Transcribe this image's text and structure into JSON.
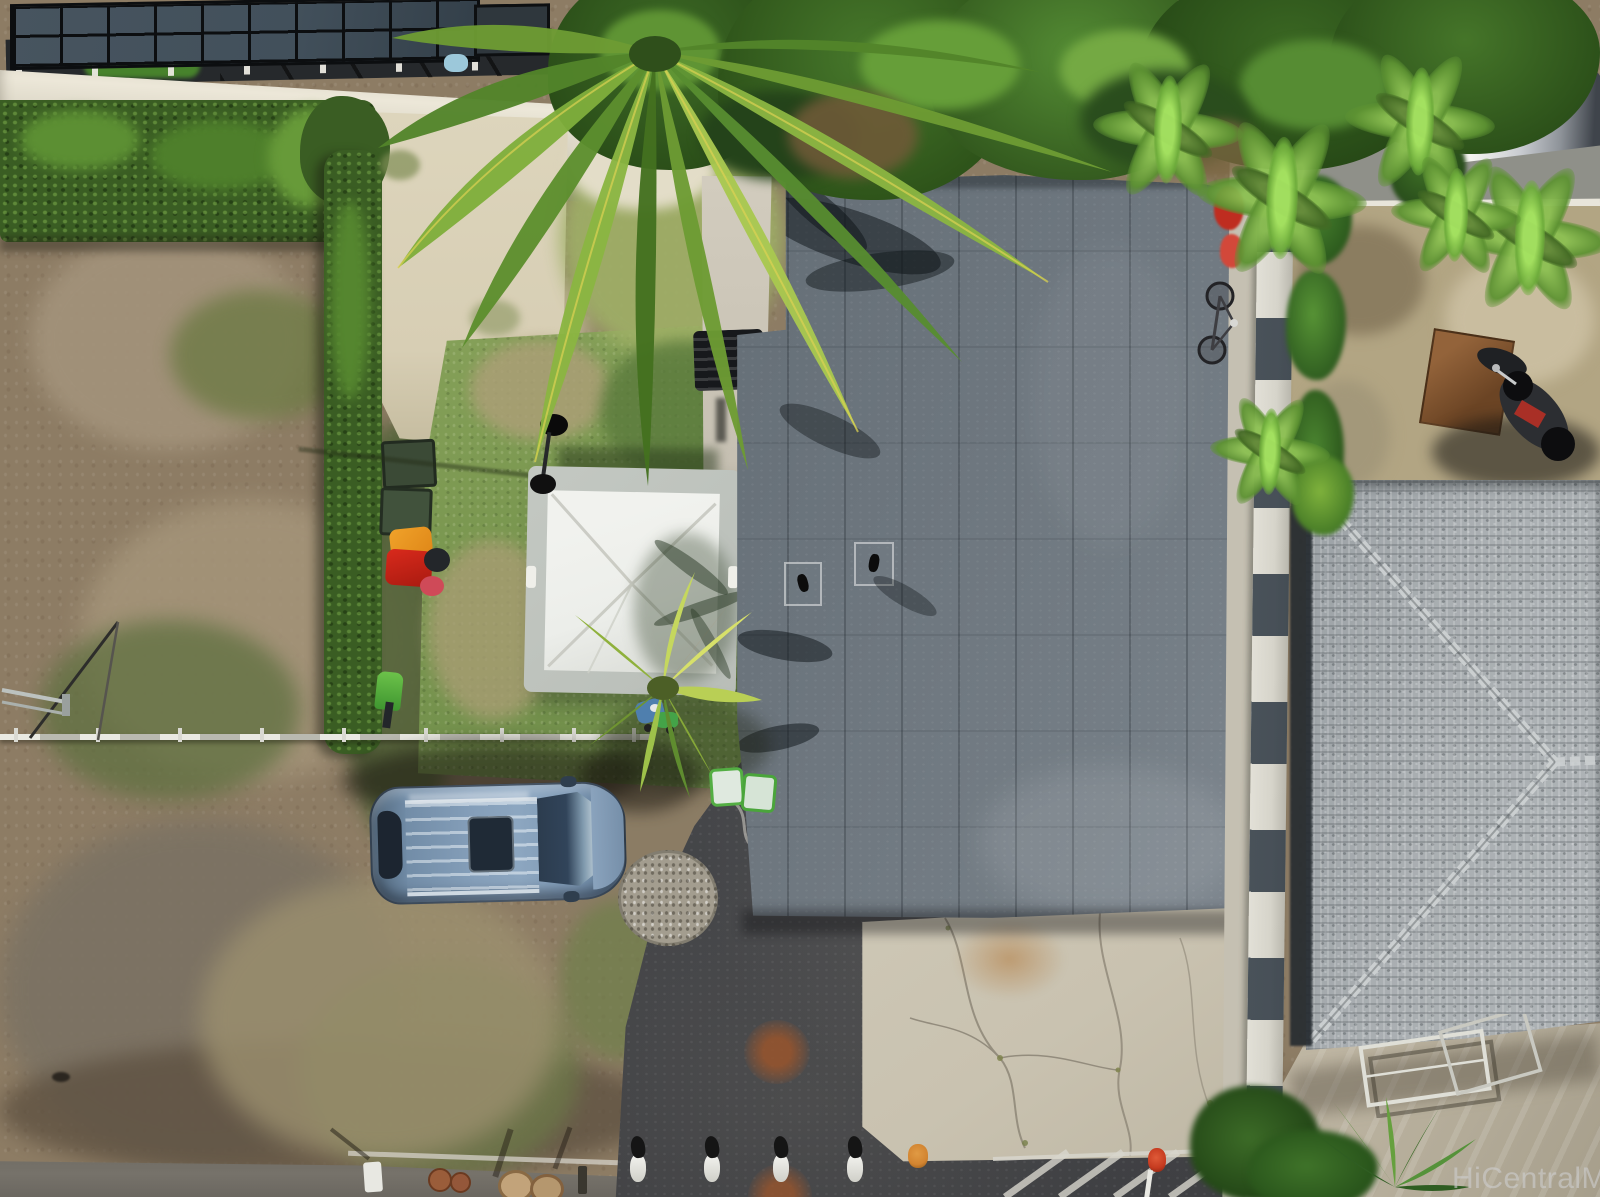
{
  "watermark": {
    "text": "HiCentralMLS"
  },
  "palette": {
    "dirt": "#8d7c64",
    "dirt_dark": "#5c4f3f",
    "sand": "#d7ceb4",
    "grass": "#7a9750",
    "grass_dead": "#ab9f76",
    "hedge": "#3a5d23",
    "palm_light": "#a9c84f",
    "palm_mid": "#6d9b33",
    "palm_dark": "#44701f",
    "roof_main": "#6e777f",
    "roof_seam": "#1a2026",
    "shingle": "#a9aeb1",
    "asphalt": "#46474a",
    "concrete_pad": "#c9c2b0",
    "concrete_wall": "#d9d4c4",
    "fence_white": "#d6d4ca",
    "fence_panel": "#39424c",
    "canopy_border": "#b9beb8",
    "canopy_top": "#eceeea",
    "car_body": "#86a0bb",
    "car_glass": "#2c3c4e",
    "solar_panel": "#42505b",
    "solar_grid": "#0c0e10",
    "rust": "#95542e",
    "gravel": "#a39d8f",
    "road": "#76726a",
    "watermark": "#cdcdcd"
  }
}
